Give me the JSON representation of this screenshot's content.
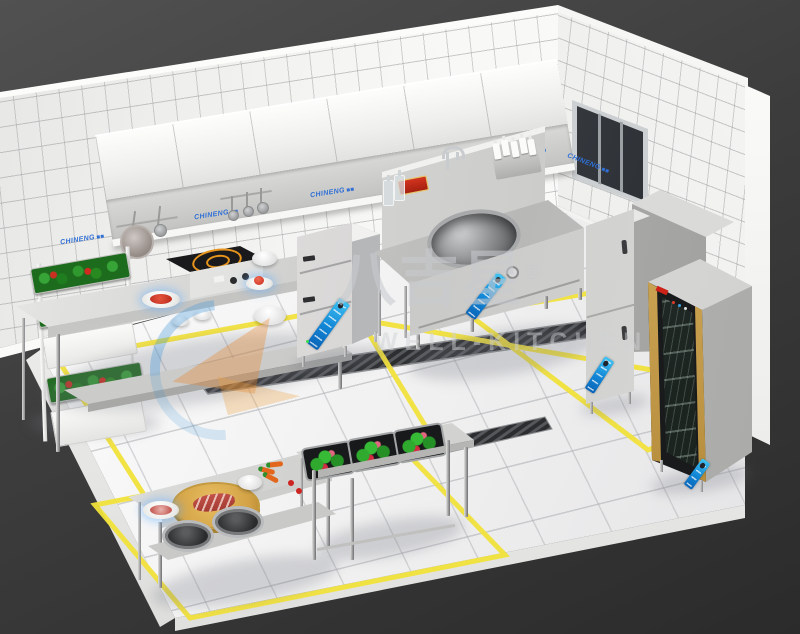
{
  "scene": {
    "description": "3D isometric rendering of a commercial kitchen layout with tiled walls, stainless equipment and yellow floor zone markings",
    "background_color": "#3a3a3a",
    "tile_color": "#f3f3f1",
    "floor_color": "#f0f0ee",
    "marking_yellow": "#f2e23c",
    "brand_blue": "#2f6fd6",
    "sticker_blue": "#1286d6",
    "trim_gold": "#caa24e"
  },
  "watermark": {
    "brand_cn": "八吉星",
    "registered": "®",
    "brand_en": "WELL-KITCHEN"
  },
  "wall_logo": {
    "label": "CHINENG"
  },
  "equipment": {
    "items": [
      "exhaust-hood",
      "wall-cabinets",
      "hanging-pan",
      "hanging-ladles",
      "vegetable-rack",
      "work-table",
      "induction-cooker",
      "steam-cabinet",
      "wok-station",
      "faucet",
      "sauce-bottle-rack",
      "upright-fridge",
      "tall-cabinet",
      "disinfection-cabinet",
      "window",
      "prep-table",
      "cutting-board",
      "triple-wash-sink",
      "floor-drain-grate",
      "floor-marking-lines"
    ]
  }
}
